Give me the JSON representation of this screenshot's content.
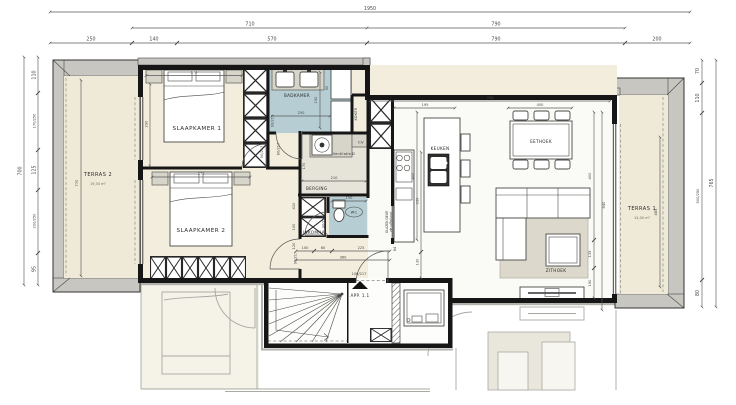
{
  "title": {
    "drawing_unit": "APP. 1.1"
  },
  "colors": {
    "wall": "#161616",
    "cream": "#f2eddc",
    "living": "#fafaf6",
    "bath": "#b5cdd3",
    "terrace": "#efe9d7",
    "band": "#c7c6c1",
    "berging": "#e6e3d8",
    "rug": "#dcd8cc",
    "furniture": "#d7d4c9",
    "faded": "#a9a9a3",
    "dim_text": "#4a4a4a",
    "label_text": "#2a2a2a"
  },
  "rooms": {
    "slaapkamer1": "SLAAPKAMER 1",
    "slaapkamer2": "SLAAPKAMER 2",
    "badkamer": "BADKAMER",
    "berging": "BERGING",
    "inkomhal": "INKOMHAL",
    "wc": "WC",
    "keuken": "KEUKEN",
    "eethoek": "EETHOEK",
    "zithoek": "ZITHOEK",
    "koker": "KOKER",
    "cv": "CV",
    "ventilatie": "Ventilatie D",
    "app": "APP. 1.1",
    "terras1": {
      "name": "TERRAS 1",
      "area": "14,00 m²"
    },
    "terras2": {
      "name": "TERRAS 2",
      "area": "19,34 m²"
    }
  },
  "dims": {
    "top": {
      "total": "1950",
      "row2": [
        "710",
        "790"
      ],
      "row3": [
        "250",
        "140",
        "570",
        "790",
        "200"
      ]
    },
    "left": {
      "total": "700",
      "segs": [
        "110",
        "170/250",
        "125",
        "200/250",
        "95"
      ]
    },
    "right": {
      "total": "765",
      "segs": [
        "70",
        "110",
        "500/250",
        "80"
      ]
    },
    "interior": {
      "terras2_d": "770",
      "terras1_d": "485",
      "slk1_w": "370",
      "slk1_d": "290",
      "slk2_w": "370",
      "bad_w": "250",
      "bad_a": "190",
      "bad_b": "90",
      "berging_w": "210",
      "berging_d": "170",
      "wc_w": "150",
      "hal": [
        "100",
        "60",
        "225",
        "360",
        "84"
      ],
      "hal_col": [
        "410",
        "100",
        "120"
      ],
      "liv_w": "705",
      "kit_w": "195",
      "eet_w": "450",
      "kit_d": "400",
      "kit_b": "330",
      "kit_c": "130",
      "liv_d": "400",
      "zit_a": "640",
      "zit_b": "135",
      "zit_c": "150"
    },
    "doors": {
      "d90": "90/217",
      "d80": "80/217",
      "d106": "106/217"
    }
  },
  "notes": {
    "glazen_deur_1": "GLAZEN DEUR",
    "glazen_deur_2": "zie p/Rolland"
  }
}
